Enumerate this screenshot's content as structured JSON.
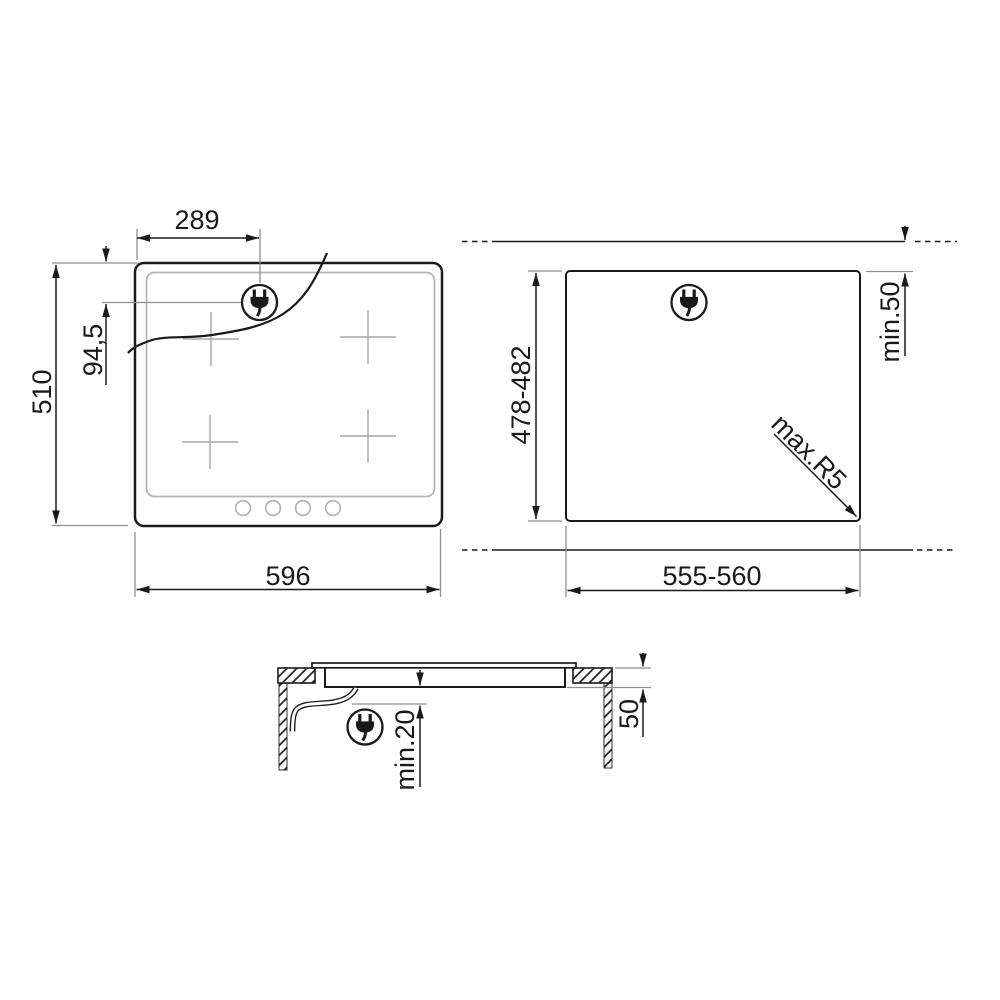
{
  "diagram": {
    "title": "hob-installation-dimensions",
    "colors": {
      "line": "#1a1a1a",
      "extension_line": "#8f8f8f",
      "detail_gray": "#b4b4b4",
      "background": "#ffffff"
    },
    "icons": {
      "power_plug": "power-plug-icon"
    },
    "views": {
      "top_view": {
        "labels": {
          "plug_offset_x": "289",
          "plug_offset_y": "94,5",
          "height": "510",
          "width": "596"
        }
      },
      "cutout_view": {
        "labels": {
          "height": "478-482",
          "width": "555-560",
          "rear_distance": "min.50",
          "corner_radius": "max.R5"
        }
      },
      "section_view": {
        "labels": {
          "bottom_clearance": "min.20",
          "recess_depth": "50"
        }
      }
    }
  }
}
